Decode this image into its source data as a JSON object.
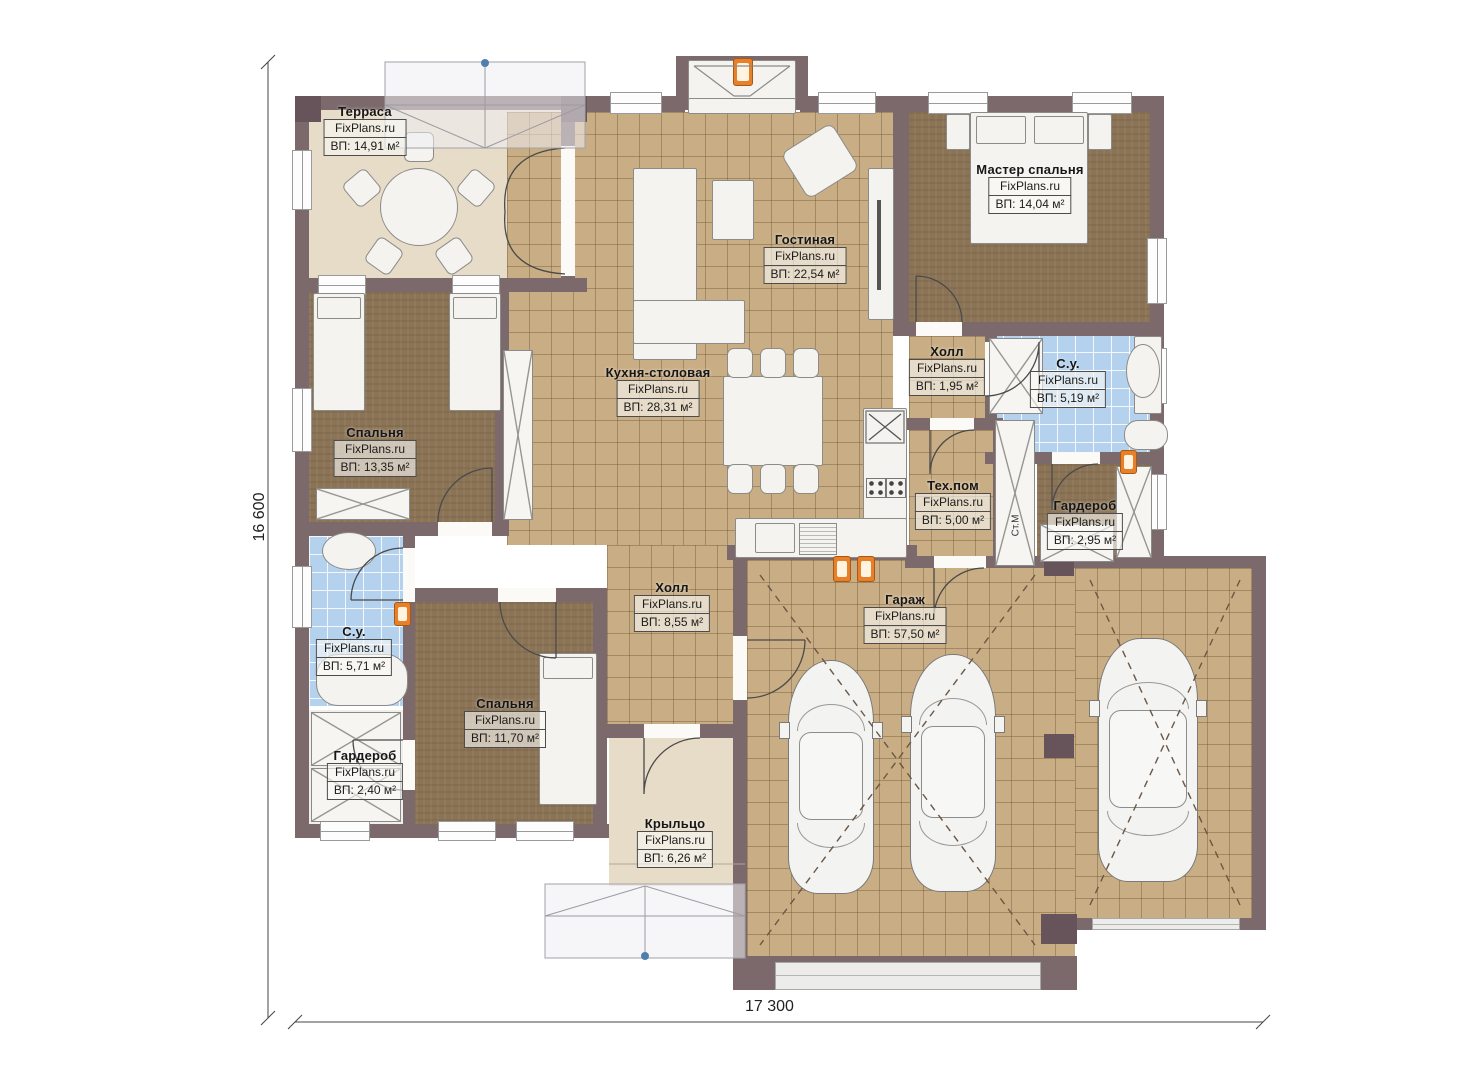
{
  "watermark": "FixPlans.ru",
  "dimension_labels": {
    "height": "16 600",
    "width": "17 300"
  },
  "annotations": {
    "washing_machine": "Ст.М"
  },
  "rooms": [
    {
      "name": "Терраса",
      "area": "ВП: 14,91 м²"
    },
    {
      "name": "Гостиная",
      "area": "ВП: 22,54 м²"
    },
    {
      "name": "Мастер спальня",
      "area": "ВП: 14,04 м²"
    },
    {
      "name": "Кухня-столовая",
      "area": "ВП: 28,31 м²"
    },
    {
      "name": "Спальня",
      "area": "ВП: 13,35 м²"
    },
    {
      "name": "Холл",
      "area": "ВП: 1,95 м²"
    },
    {
      "name": "С.у.",
      "area": "ВП: 5,19 м²"
    },
    {
      "name": "Тех.пом",
      "area": "ВП: 5,00 м²"
    },
    {
      "name": "Гардероб",
      "area": "ВП: 2,95 м²"
    },
    {
      "name": "Холл",
      "area": "ВП: 8,55 м²"
    },
    {
      "name": "С.у.",
      "area": "ВП: 5,71 м²"
    },
    {
      "name": "Гардероб",
      "area": "ВП: 2,40 м²"
    },
    {
      "name": "Спальня",
      "area": "ВП: 11,70 м²"
    },
    {
      "name": "Крыльцо",
      "area": "ВП: 6,26 м²"
    },
    {
      "name": "Гараж",
      "area": "ВП: 57,50 м²"
    }
  ],
  "colors": {
    "wall": "#7c696c",
    "tile_floor": "#c9ae85",
    "wood_floor": "#8b7456",
    "terrace_floor": "#e7dcc8",
    "bath_tile": "#b4d2ee",
    "heater_orange": "#e8802a",
    "roof_marker_blue": "#4f7fae"
  }
}
